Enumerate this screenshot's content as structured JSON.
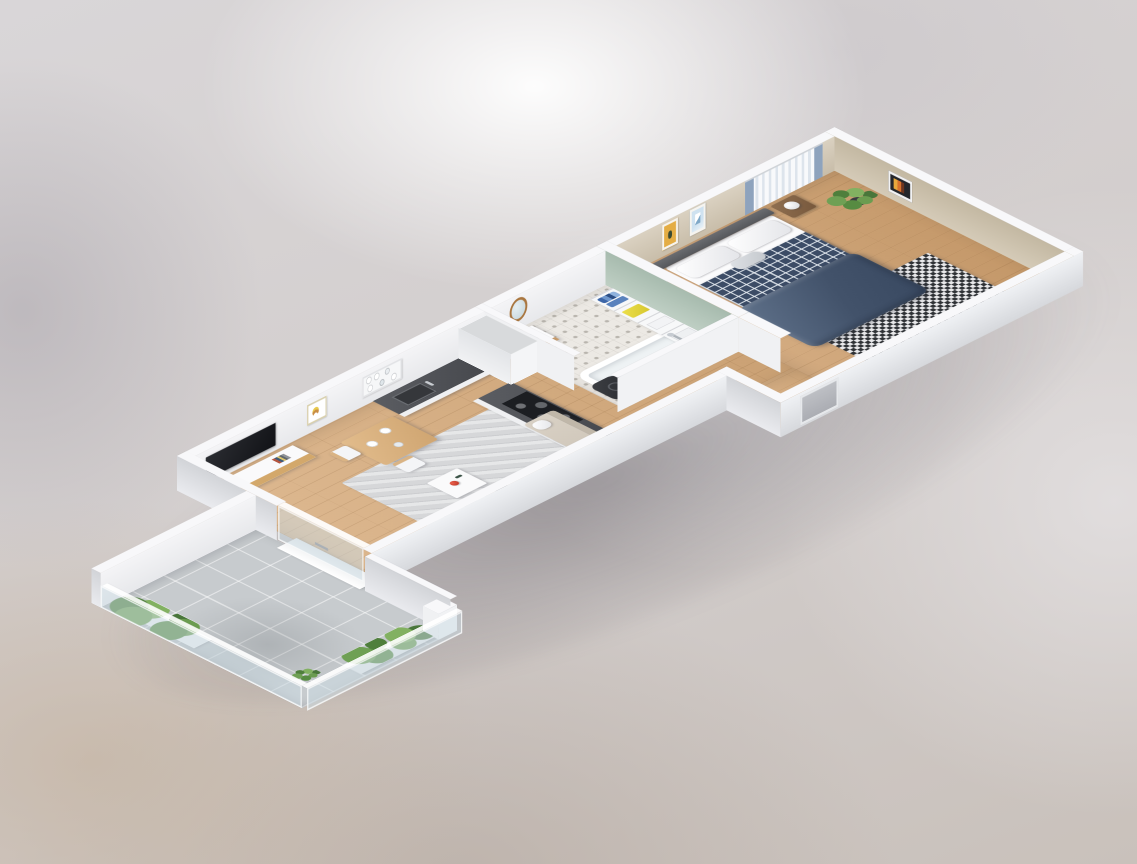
{
  "scene": {
    "label": "3D isometric cutaway floor plan of a one-bedroom apartment",
    "backdrop": "soft blurred gray-beige studio background",
    "projection": "isometric"
  },
  "palette": {
    "wall_top_white": "#f8f8fa",
    "wall_inner_light": "#efeff2",
    "wall_inner_beige": "#cfc5b2",
    "wall_sage_green": "#b2c4b7",
    "wall_outer_gray": "#d9dbdf",
    "floor_wood": "#d7ab7b",
    "floor_bath_tile": "#ece9e4",
    "balcony_stone": "#c7cbce",
    "countertop_dark": "#505257",
    "sofa_beige": "#d1c8bc",
    "plaid_navy": "#3c4c66",
    "duvet_slate": "#46566e",
    "rug_gray": "#d6d7d9",
    "rug_checker_dark": "#2e3135",
    "accent_red": "#cf3a2a",
    "accent_yellow": "#e3d43c",
    "storage_blue": "#3d66a8",
    "plant_green": "#5d8a4a",
    "wood_furniture": "#d3a86b"
  },
  "labels": {
    "apartment": "3D apartment floor plan",
    "balcony": "Balcony",
    "living": "Living room",
    "kitchen": "Kitchen",
    "bathroom": "Bathroom",
    "hallway": "Hallway",
    "bedroom": "Bedroom",
    "sofa": "Corner sofa",
    "coffee_table": "Coffee table",
    "teapot": "Red teapot",
    "rug_living": "Living room rug",
    "tv": "Flat-screen TV",
    "tv_console": "TV console",
    "poster": "Framed wall art",
    "dining_table": "Dining table",
    "dining_chair": "Dining chair",
    "floor_lamp": "Floor lamp",
    "kitchen_counter": "Kitchen counter with sink",
    "cooktop_counter": "Cooktop and oven unit",
    "tall_cabinet": "Tall cabinet",
    "dish_shelf": "Open shelf with dishes",
    "bathtub": "Bathtub",
    "vanity": "Washbasin vanity",
    "mirror": "Round mirror",
    "laundry": "Laundry bin",
    "storage_shelf": "Storage shelf with boxes",
    "bed": "Double bed",
    "plaid": "Plaid blanket",
    "duvet": "Navy duvet",
    "nightstand": "Nightstand",
    "lamp": "Sphere table lamp",
    "rug_bedroom": "Checkered rug",
    "curtain": "Window curtains",
    "art": "Framed art",
    "plant": "Potted plant",
    "railing": "Glass balcony railing",
    "planter": "Planter with greenery",
    "door": "Sliding balcony door",
    "entrance": "Entrance door recess"
  },
  "rooms": {
    "balcony": {
      "label": "Balcony",
      "items": [
        "stone tile floor",
        "glass railing",
        "white parapet",
        "planter boxes",
        "green plants",
        "corner post"
      ]
    },
    "living": {
      "label": "Living room",
      "items": [
        "corner sofa with cushions",
        "gray area rug",
        "white coffee table",
        "red teapot",
        "TV on console",
        "framed abstract poster",
        "floor lamp",
        "dining table with two chairs",
        "white plates"
      ]
    },
    "kitchen": {
      "label": "Kitchen",
      "items": [
        "white cabinets with dark countertop",
        "sink with faucet",
        "black cooktop",
        "oven",
        "tall cabinet",
        "open shelf with dishes"
      ]
    },
    "bathroom": {
      "label": "Bathroom",
      "items": [
        "white bathtub with chrome faucet",
        "round wood-framed mirror",
        "washbasin vanity",
        "dark laundry bin",
        "storage shelf with blue bottles, yellow box and towels",
        "patterned tile floor",
        "sage green wall"
      ]
    },
    "hallway": {
      "label": "Hallway",
      "items": [
        "wood floor",
        "entrance door recess"
      ]
    },
    "bedroom": {
      "label": "Bedroom",
      "items": [
        "double bed with gray headboard",
        "white pillows",
        "navy plaid blanket",
        "navy duvet",
        "two nightstands with sphere lamps",
        "black and white checkered rug",
        "two framed pictures",
        "curtained window",
        "framed poster on end wall",
        "potted plant",
        "beige walls"
      ]
    }
  }
}
